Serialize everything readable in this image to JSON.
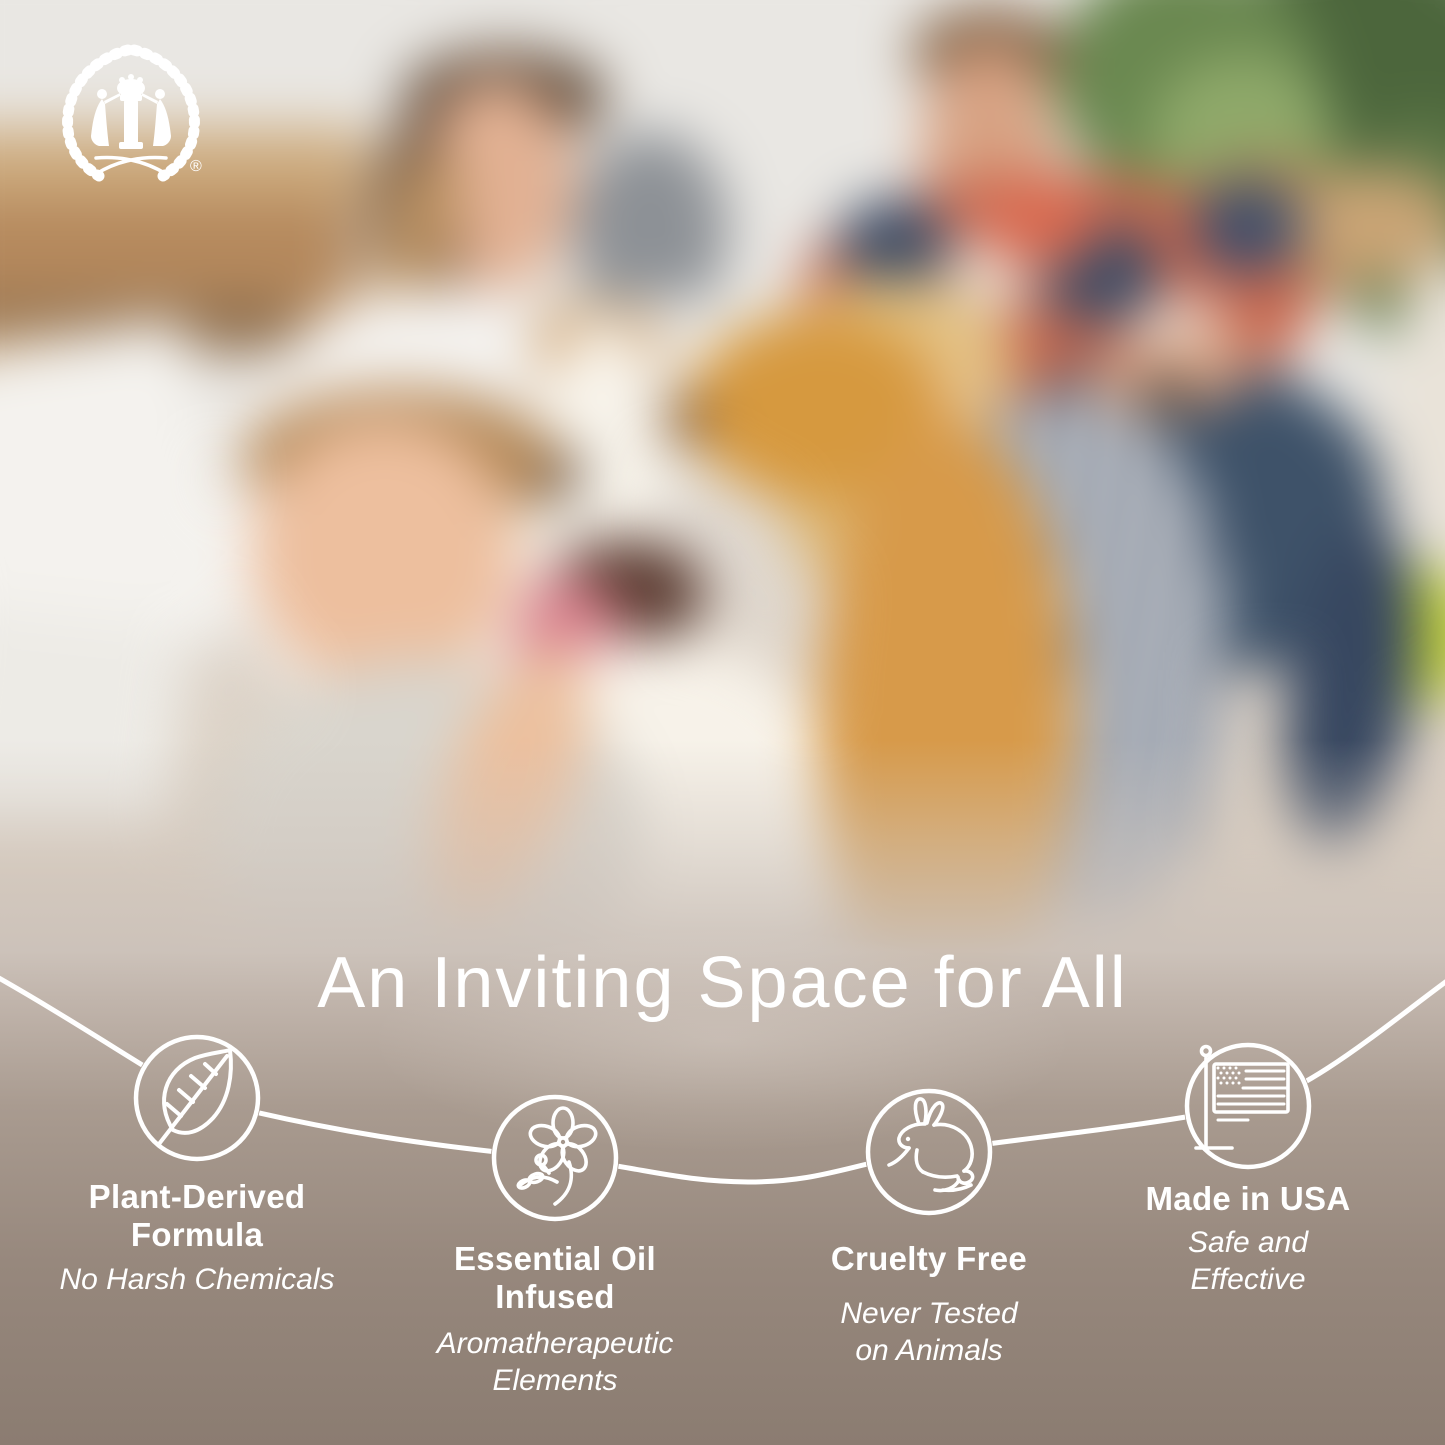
{
  "logo": {
    "name": "laurel-wreath-brand-emblem",
    "registered_mark": "®"
  },
  "photo": {
    "alt": "Blurred photo of a family — mother, father, boy, girl — sitting with a golden-and-white dog among cardboard moving boxes"
  },
  "headline": "An Inviting Space for All",
  "features": [
    {
      "icon": "leaf-icon",
      "title": "Plant-Derived\nFormula",
      "subtitle": "No Harsh Chemicals"
    },
    {
      "icon": "flower-icon",
      "title": "Essential Oil\nInfused",
      "subtitle": "Aromatherapeutic\nElements"
    },
    {
      "icon": "rabbit-icon",
      "title": "Cruelty Free",
      "subtitle": "Never Tested\non Animals"
    },
    {
      "icon": "usa-flag-icon",
      "title": "Made in USA",
      "subtitle": "Safe and\nEffective"
    }
  ],
  "colors": {
    "text": "#ffffff",
    "line_art": "#ffffff",
    "panel_bottom": "#8b7c71",
    "panel_mid": "#c2b6ad",
    "dog_gold": "#d6993f",
    "pillow_green": "#c0cf3b",
    "jeans_blue": "#3e5269"
  }
}
